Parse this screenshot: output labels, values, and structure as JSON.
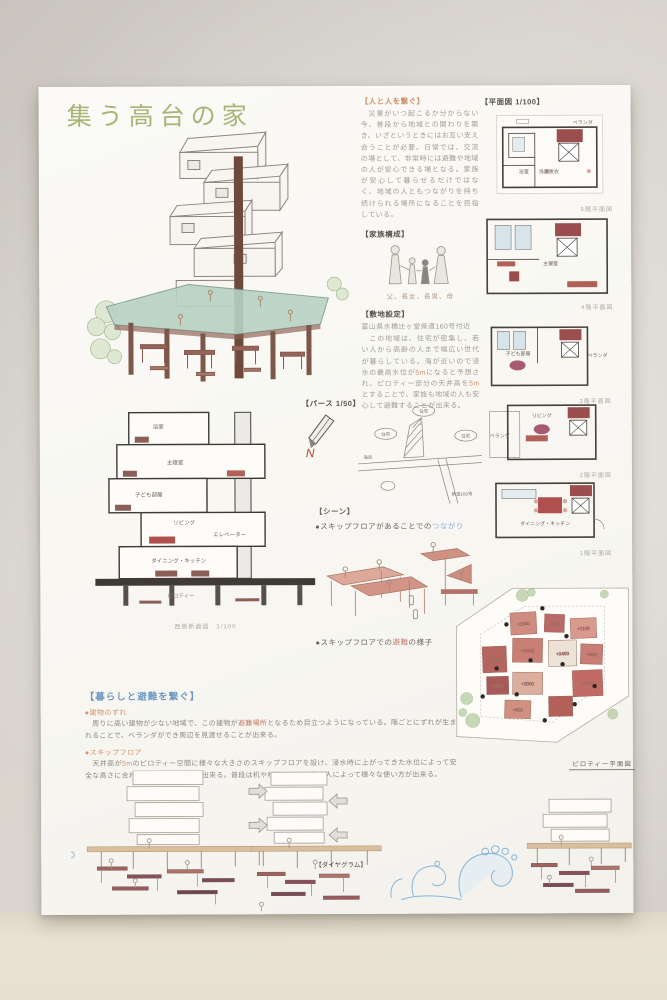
{
  "accents": {
    "title_green": "#a9b478",
    "heading_orange": "#d1926a",
    "heading_blue": "#6f9bc4",
    "highlight_blue": "#8fb3d6",
    "highlight_red": "#c77b6b",
    "plan_stair_red": "#9a4f4e",
    "deck_green": "#b7d2c2",
    "wave_blue": "#85b5d8"
  },
  "poster": {
    "title": "集う高台の家",
    "perspective_label": "【パース 1/50】",
    "north_label": "N",
    "connect": {
      "heading": "【人と人を繋ぐ】",
      "body": "　災害がいつ起こるか分からない今、普段から地域との関わりを築き、いざというときにはお互い支え合うことが必要。日常では、交流の場として、非常時には避難や地域の人が安心できる場となる。家族が安心して暮らせるだけではなく、地域の人ともつながりを持ち続けられる場所になることを目指している。"
    },
    "family": {
      "heading": "【家族構成】",
      "caption": "父、長女、長男、母"
    },
    "site": {
      "heading": "【敷地設定】",
      "address": "富山県水橋辻ヶ堂県道160号付近",
      "body_1": "　この地域は、住宅が密集し、若い人から高齢の人まで幅広い世代が暮らしている。海が近いので浸水の最高水位が",
      "hl_1": "5m",
      "body_2": "になると予想され、ピロティー部分の天井高を",
      "hl_2": "5m",
      "body_3": "とすることで、家族も地域の人も安心して避難することが出来る。",
      "arrow": "↓"
    },
    "map": {
      "houses": [
        "住宅",
        "住宅",
        "住宅"
      ],
      "coast": "海岸",
      "road": "県道160号"
    },
    "plans": {
      "header": "【平面図 1/100】",
      "items": [
        {
          "caption": "5階平面図",
          "veranda": "ベランダ",
          "bath": "浴室",
          "wash": "洗面脱衣"
        },
        {
          "caption": "4階平面図",
          "room": "主寝室"
        },
        {
          "caption": "3階平面図",
          "room": "子ども部屋",
          "veranda": "ベランダ"
        },
        {
          "caption": "2階平面図",
          "room": "リビング",
          "veranda": "ベランダ"
        },
        {
          "caption": "1階平面図",
          "room": "ダイニング・キッチン"
        }
      ]
    },
    "section": {
      "caption": "西側断面図　1/100",
      "labels": [
        "浴室",
        "主寝室",
        "子ども部屋",
        "リビング",
        "エレベーター",
        "ダイニング・キッチン",
        "ピロティー"
      ]
    },
    "scene": {
      "heading": "【シーン】",
      "b1_pre": "●スキップフロアがあることでの",
      "b1_hl": "つながり",
      "b2_pre": "●スキップフロアでの",
      "b2_hl": "避難",
      "b2_post": "の様子"
    },
    "lifestyle": {
      "heading": "【暮らしと避難を繋ぐ】",
      "b1_label": "●建物のずれ",
      "b1_pre": "　周りに高い建物が少ない地域で、この建物が",
      "b1_hl": "避難場所",
      "b1_post": "となるため目立つようになっている。階ごとにずれが生まれることで、ベランダができ周辺を見渡せることが出来る。",
      "b2_label": "●スキップフロア",
      "b2_pre": "　天井高が",
      "b2_hl": "5m",
      "b2_post": "のピロティー空間に様々な大きさのスキップフロアを設け、浸水時に上がってきた水位によって安全な高さに合わせて避難することが出来る。普段は机や椅子として、使う人によって様々な使い方が出来る。"
    },
    "pilotis": {
      "caption": "ピロティー平面図",
      "levels": [
        "+1500",
        "+400",
        "+1100",
        "+1500",
        "+2400",
        "+2000",
        "+800",
        "+600",
        "+2000",
        "+1000",
        "+800"
      ]
    },
    "diagram_label": "【ダイヤグラム】"
  }
}
